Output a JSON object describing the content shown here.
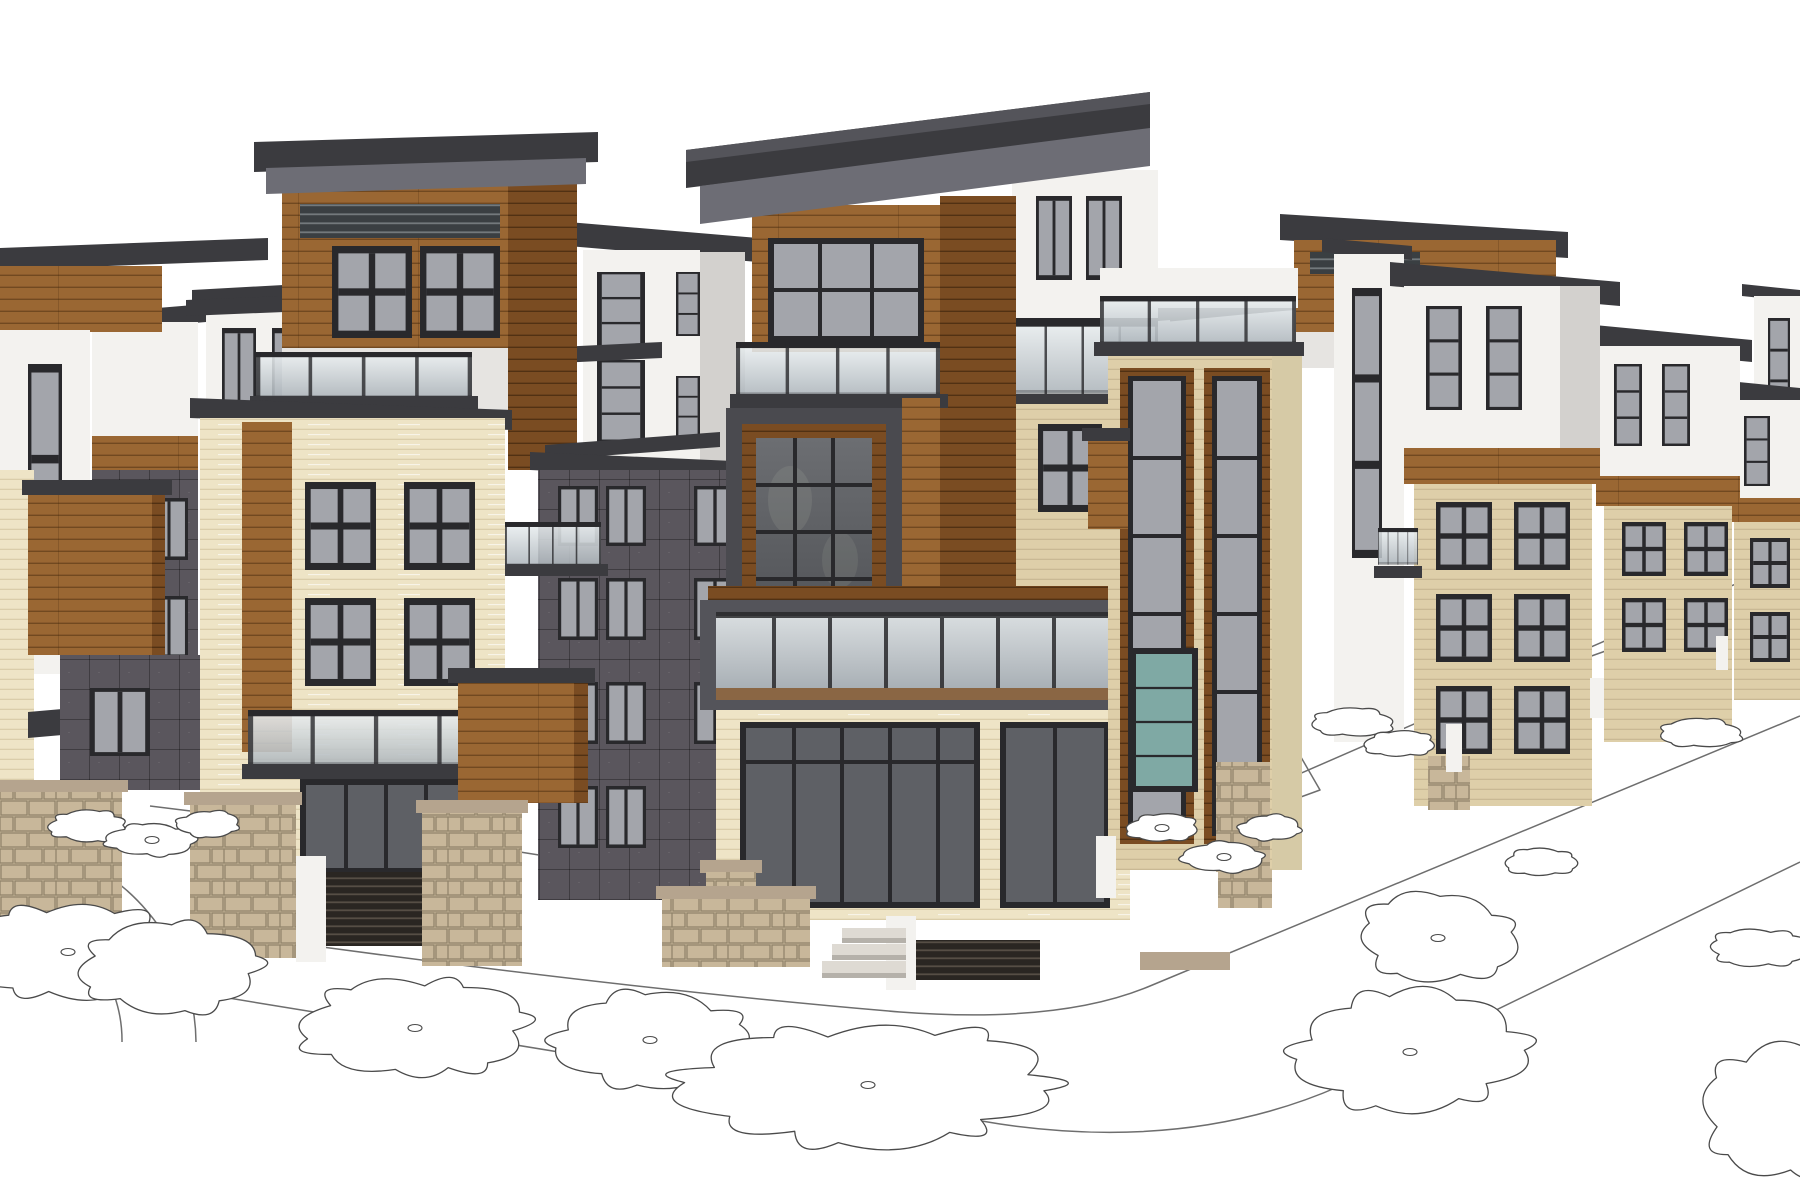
{
  "scene": {
    "title": "Architectural massing rendering — modern multifamily townhome development",
    "render_style": "SketchUp-style 3D exterior visualization, white background, line-drawn ground plane",
    "camera": "two-point street-corner perspective",
    "sky_color": "#ffffff",
    "buildings": [
      {
        "id": "far-left-block",
        "materials": [
          "white stucco",
          "wood siding",
          "cream brick"
        ],
        "floors": 4
      },
      {
        "id": "left-background-towers",
        "materials": [
          "white stucco",
          "wood band",
          "dark fiber-cement panel"
        ],
        "floors": 4
      },
      {
        "id": "left-wood-balcony-box",
        "materials": [
          "wood siding",
          "stone base"
        ],
        "floors": 1
      },
      {
        "id": "left-wood-top-tower",
        "materials": [
          "wood siding",
          "glass railing",
          "dark flat roof"
        ],
        "floors": 5
      },
      {
        "id": "left-white-tower",
        "materials": [
          "white stucco",
          "glass railing"
        ],
        "floors": 4
      },
      {
        "id": "left-cream-building",
        "materials": [
          "cream brick",
          "wood accent",
          "glass railing",
          "stone base"
        ],
        "floors": 4
      },
      {
        "id": "dark-panel-building",
        "materials": [
          "dark fiber-cement panel"
        ],
        "floors": 4
      },
      {
        "id": "center-tower",
        "materials": [
          "wood siding",
          "cream brick",
          "white stucco",
          "glass balcony",
          "stone base"
        ],
        "floors": 5
      },
      {
        "id": "right-mid-tower",
        "materials": [
          "cream brick",
          "wood trim",
          "teal glass",
          "stone base"
        ],
        "floors": 5
      },
      {
        "id": "right-receding-row",
        "materials": [
          "white stucco",
          "wood band",
          "cream brick"
        ],
        "floors": 4
      }
    ],
    "landscape": {
      "ground_color": "#ffffff",
      "street_features": [
        "curved curb corner",
        "sidewalk with parkway planting strips",
        "circular plaza arcs",
        "entry steps",
        "stone privacy walls",
        "wood slat fences"
      ],
      "plan_trees": [
        {
          "cx": 88,
          "cy": 826,
          "rx": 38,
          "ry": 14,
          "lobes": 9,
          "dot": false
        },
        {
          "cx": 152,
          "cy": 840,
          "rx": 42,
          "ry": 15,
          "lobes": 9,
          "dot": true
        },
        {
          "cx": 208,
          "cy": 824,
          "rx": 30,
          "ry": 12,
          "lobes": 8,
          "dot": false
        },
        {
          "cx": 68,
          "cy": 952,
          "rx": 96,
          "ry": 44,
          "lobes": 11,
          "dot": true
        },
        {
          "cx": 170,
          "cy": 968,
          "rx": 86,
          "ry": 40,
          "lobes": 10,
          "dot": false
        },
        {
          "cx": 415,
          "cy": 1028,
          "rx": 102,
          "ry": 46,
          "lobes": 11,
          "dot": true
        },
        {
          "cx": 650,
          "cy": 1040,
          "rx": 92,
          "ry": 42,
          "lobes": 10,
          "dot": true
        },
        {
          "cx": 868,
          "cy": 1085,
          "rx": 170,
          "ry": 54,
          "lobes": 13,
          "dot": true
        },
        {
          "cx": 1162,
          "cy": 828,
          "rx": 34,
          "ry": 13,
          "lobes": 8,
          "dot": true
        },
        {
          "cx": 1224,
          "cy": 857,
          "rx": 38,
          "ry": 14,
          "lobes": 8,
          "dot": true
        },
        {
          "cx": 1270,
          "cy": 828,
          "rx": 29,
          "ry": 12,
          "lobes": 8,
          "dot": false
        },
        {
          "cx": 1352,
          "cy": 722,
          "rx": 40,
          "ry": 13,
          "lobes": 8,
          "dot": false
        },
        {
          "cx": 1400,
          "cy": 744,
          "rx": 33,
          "ry": 12,
          "lobes": 8,
          "dot": false
        },
        {
          "cx": 1438,
          "cy": 938,
          "rx": 74,
          "ry": 40,
          "lobes": 9,
          "dot": true
        },
        {
          "cx": 1410,
          "cy": 1052,
          "rx": 110,
          "ry": 52,
          "lobes": 11,
          "dot": true
        },
        {
          "cx": 1700,
          "cy": 733,
          "rx": 40,
          "ry": 13,
          "lobes": 8,
          "dot": false
        },
        {
          "cx": 1542,
          "cy": 862,
          "rx": 34,
          "ry": 13,
          "lobes": 8,
          "dot": false
        },
        {
          "cx": 1758,
          "cy": 948,
          "rx": 46,
          "ry": 17,
          "lobes": 9,
          "dot": false
        },
        {
          "cx": 1790,
          "cy": 1108,
          "rx": 80,
          "ry": 62,
          "lobes": 10,
          "dot": false
        }
      ]
    }
  },
  "palette": {
    "sky": "#ffffff",
    "line": "#6e6e6e",
    "tree-line": "#4a4a4a",
    "roof": "#3b3b3f",
    "roof-top": "#54545a",
    "fascia": "#6d6d75",
    "white-wall": "#f3f2ef",
    "white-shade": "#e6e4e1",
    "white-dark": "#d3d1ce",
    "wood": "#9a6733",
    "wood-dark": "#7a4c22",
    "wood-light": "#ad7c46",
    "cream": "#eee4c6",
    "cream-shade": "#decfa9",
    "cream-line": "#c9ba93",
    "panel-dark": "#5a565d",
    "panel-deep": "#4b474e",
    "panel-light": "#716d76",
    "frame": "#29292c",
    "glass": "#a3a5ab",
    "glass-dark": "#5e6065",
    "step": "#dedad3",
    "step-shade": "#b5b1aa",
    "stone": "#c8b79a",
    "stone-line": "#8e8168",
    "tan": "#b5a48e",
    "slat-dark": "#2a2622",
    "slat-light": "#564e45",
    "deck": "#8a6644",
    "teal": "#7fa9a4"
  }
}
